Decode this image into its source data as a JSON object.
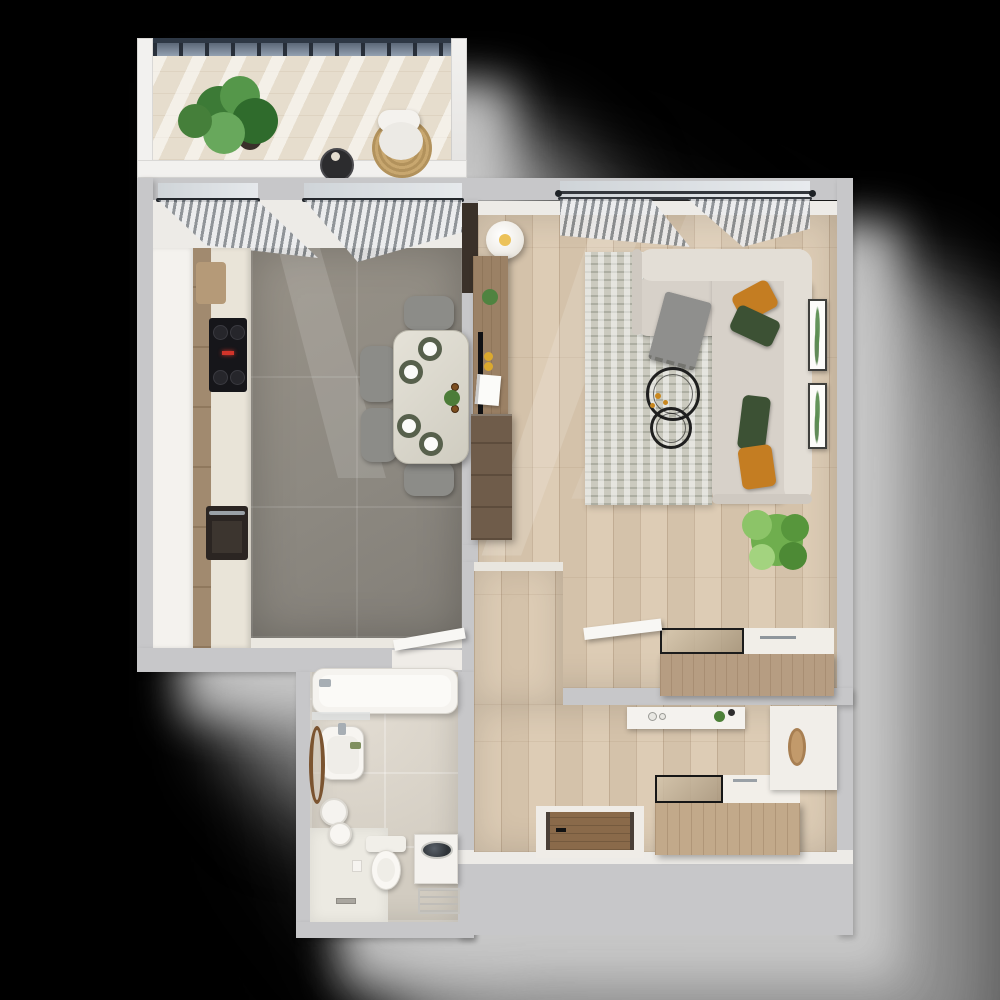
{
  "meta": {
    "title": "3D top-down render of a one-bedroom apartment floor plan on a black background",
    "type": "floor-plan-render"
  },
  "palette": {
    "background": "#000000",
    "outer_wall": "#c7c7c9",
    "inner_wall": "#edebe7",
    "kitchen_tile": "#8e8a84",
    "wood_floor": "#d8c7b0",
    "bath_tile": "#d7d1c7",
    "sofa": "#d7d1c9",
    "rug": "#cbcabf",
    "accent_orange": "#c47d22",
    "accent_green": "#3c5134",
    "plant_green": "#6fae4e",
    "glass_railing": "#39424e",
    "console_wood": "#9b8165",
    "dark_cabinet": "#6f5c4a",
    "shadow_gray": "#b5b5b5"
  },
  "rooms": {
    "balcony": {
      "label": "Balcony",
      "furniture": [
        "glass railing",
        "monstera plant",
        "round side table with candle",
        "lounge chair",
        "rattan pouf"
      ]
    },
    "kitchen": {
      "label": "Kitchen and dining area",
      "furniture": [
        "cabinet run with oven and cooktop",
        "gray stone tile floor",
        "dining table for four",
        "four upholstered chairs",
        "place settings with chargers",
        "sheer curtains on two windows"
      ]
    },
    "living": {
      "label": "Living room",
      "furniture": [
        "L-shaped corner sofa with orange and green pillows",
        "textured rug",
        "two round wire coffee tables",
        "floor lamp",
        "media console",
        "dark TV cabinet",
        "potted monstera plant",
        "two botanical wall frames",
        "sideboard with glass top",
        "open white door"
      ]
    },
    "hallway": {
      "label": "Hallway and entry",
      "furniture": [
        "wall console with decor",
        "shoe cabinet with glass top",
        "mirror cabinet",
        "entry door with wooden threshold"
      ]
    },
    "bathroom": {
      "label": "Bathroom",
      "furniture": [
        "bathtub",
        "washbasin with leaning round mirror",
        "toilet",
        "washing machine with drying rack",
        "walk-in shower with drain",
        "towels"
      ]
    }
  }
}
